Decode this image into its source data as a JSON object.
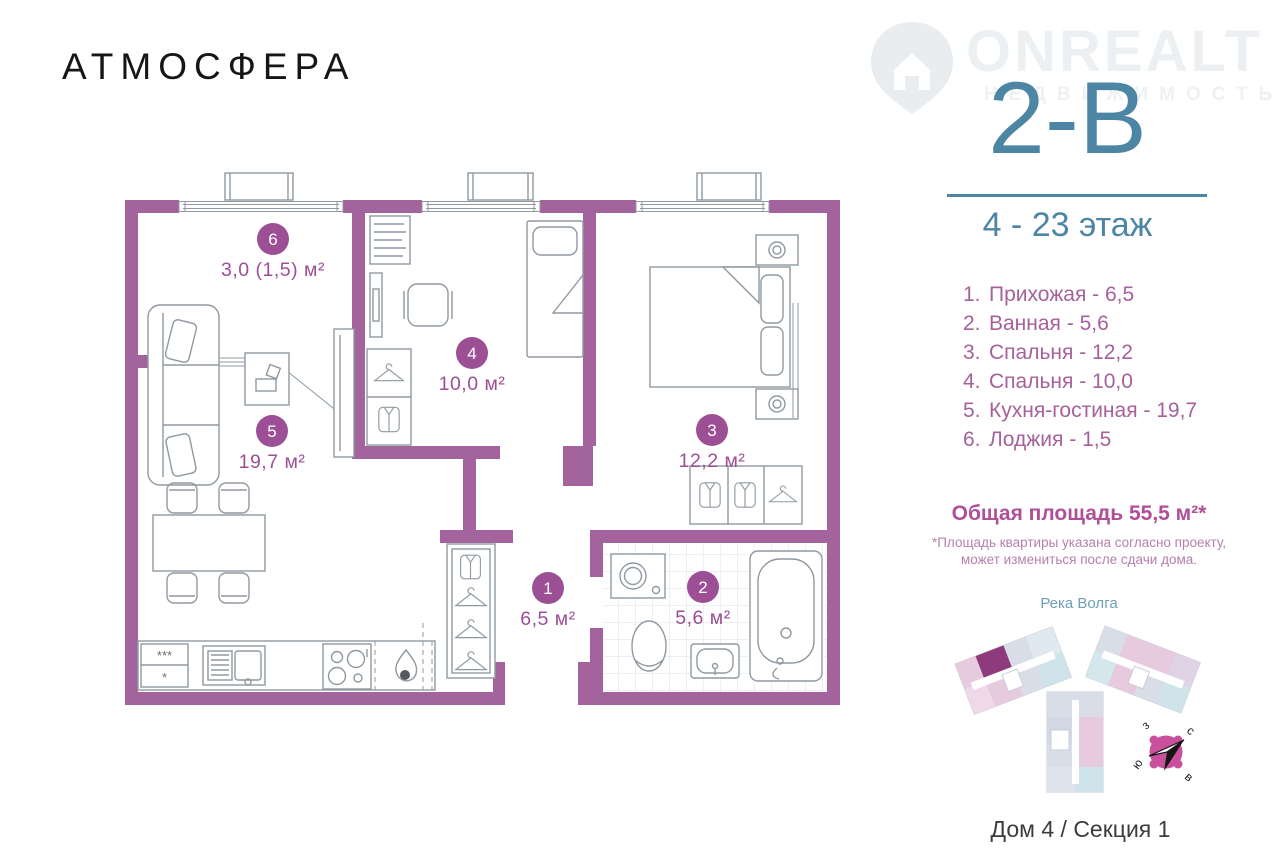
{
  "branding": {
    "logo": "АТМОСФЕРА"
  },
  "watermark": {
    "brand": "ONREALT",
    "subtitle": "НЕДВИЖИМОСТЬ"
  },
  "unit": {
    "code": "2-В",
    "floors": "4 - 23 этаж"
  },
  "room_list": {
    "items": [
      {
        "num": "1.",
        "label": "Прихожая - 6,5"
      },
      {
        "num": "2.",
        "label": "Ванная - 5,6"
      },
      {
        "num": "3.",
        "label": "Спальня - 12,2"
      },
      {
        "num": "4.",
        "label": "Спальня - 10,0"
      },
      {
        "num": "5.",
        "label": "Кухня-гостиная - 19,7"
      },
      {
        "num": "6.",
        "label": "Лоджия - 1,5"
      }
    ]
  },
  "summary": {
    "total": "Общая площадь 55,5 м²*",
    "note1": "*Площадь квартиры указана согласно проекту,",
    "note2": "может измениться после сдачи дома."
  },
  "site": {
    "river": "Река Волга",
    "caption": "Дом 4 / Секция 1",
    "compass": {
      "nw": "з",
      "ne": "с",
      "sw": "ю",
      "se": "в"
    }
  },
  "plan": {
    "rooms": [
      {
        "num": "6",
        "area": "3,0 (1,5) м²"
      },
      {
        "num": "5",
        "area": "19,7 м²"
      },
      {
        "num": "4",
        "area": "10,0 м²"
      },
      {
        "num": "3",
        "area": "12,2 м²"
      },
      {
        "num": "1",
        "area": "6,5 м²"
      },
      {
        "num": "2",
        "area": "5,6 м²"
      }
    ],
    "fridge": {
      "top": "***",
      "bottom": "*"
    }
  },
  "colors": {
    "wall": "#a3639d",
    "label": "#9c4f95",
    "accent_teal": "#4c86a4",
    "list_magenta": "#a6619a",
    "total_magenta": "#b04f98",
    "compass_pink": "#ca4f9d",
    "minimap_highlight": "#8e3b7d"
  }
}
